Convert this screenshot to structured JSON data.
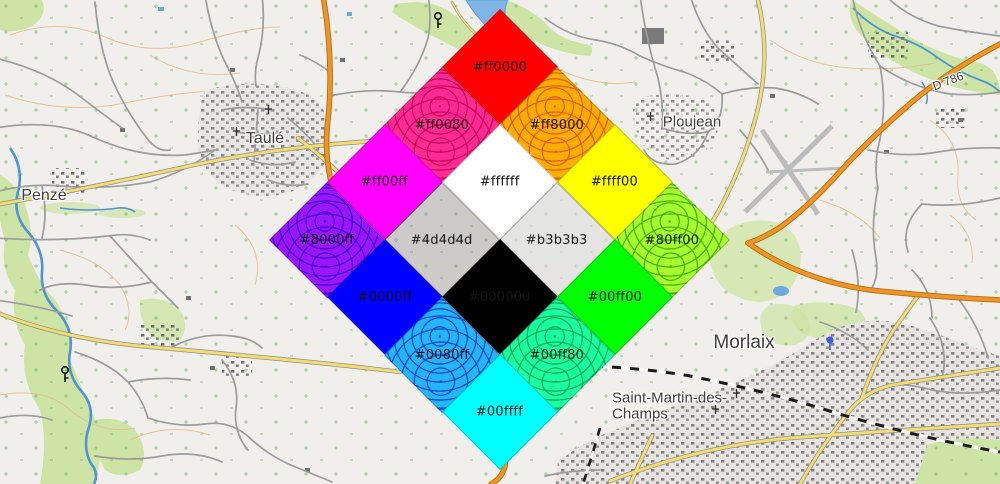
{
  "map": {
    "place_labels": [
      {
        "text": "Taulé",
        "x": 265,
        "y": 139,
        "size": 16
      },
      {
        "text": "Penzé",
        "x": 44,
        "y": 196,
        "size": 16
      },
      {
        "text": "Ploujean",
        "x": 692,
        "y": 122,
        "size": 15
      },
      {
        "text": "Morlaix",
        "x": 744,
        "y": 343,
        "size": 19
      },
      {
        "text": "Saint-Martin-des-",
        "x": 612,
        "y": 398,
        "size": 15,
        "anchor": "start"
      },
      {
        "text": "Champs",
        "x": 612,
        "y": 414,
        "size": 15,
        "anchor": "start"
      },
      {
        "text": "D 786",
        "x": 948,
        "y": 81,
        "size": 12,
        "rotate": -21
      }
    ],
    "palette": {
      "land": "#f1efeb",
      "woodland": "#cde4a4",
      "contour": "#e4bd92",
      "water": "#5d9fd3",
      "road_minor": "#9c9c9c",
      "road_secondary": "#f2dd72",
      "road_primary": "#ef9426",
      "railway": "#1a1a1a",
      "buildings": "#707070",
      "label_color": "#3e3e3e"
    }
  },
  "overlay": {
    "grid": {
      "center_x": 500,
      "top_center_y": 67.5,
      "tile_diagonal": 115
    },
    "tiles": [
      {
        "label": "#ff0000",
        "color": "#ff0000",
        "row": 0,
        "col": 0,
        "kind": "solid"
      },
      {
        "label": "#ff0080",
        "color": "#ff2b92",
        "row": 1,
        "col": 0,
        "kind": "textured",
        "texture_color": "#c7005e"
      },
      {
        "label": "#ff8000",
        "color": "#ffae00",
        "row": 0,
        "col": 1,
        "kind": "textured",
        "texture_color": "#e05d00"
      },
      {
        "label": "#ff00ff",
        "color": "#ff00ff",
        "row": 2,
        "col": 0,
        "kind": "solid"
      },
      {
        "label": "#ffffff",
        "color": "#ffffff",
        "row": 1,
        "col": 1,
        "kind": "solid"
      },
      {
        "label": "#ffff00",
        "color": "#ffff00",
        "row": 0,
        "col": 2,
        "kind": "solid"
      },
      {
        "label": "#8000ff",
        "color": "#9916ff",
        "row": 3,
        "col": 0,
        "kind": "textured",
        "texture_color": "#4b00c2"
      },
      {
        "label": "#4d4d4d",
        "color": "#4d4d4d",
        "row": 2,
        "col": 1,
        "kind": "overlay",
        "overlay_rgba": "rgba(77,77,77,0.22)"
      },
      {
        "label": "#b3b3b3",
        "color": "#b3b3b3",
        "row": 1,
        "col": 2,
        "kind": "overlay",
        "overlay_rgba": "rgba(219,219,219,0.55)"
      },
      {
        "label": "#80ff00",
        "color": "#a6ff2e",
        "row": 0,
        "col": 3,
        "kind": "textured",
        "texture_color": "#47b100"
      },
      {
        "label": "#0000ff",
        "color": "#0000ff",
        "row": 3,
        "col": 1,
        "kind": "solid"
      },
      {
        "label": "#000000",
        "color": "#000000",
        "row": 2,
        "col": 2,
        "kind": "solid"
      },
      {
        "label": "#00ff00",
        "color": "#00ff00",
        "row": 1,
        "col": 3,
        "kind": "solid"
      },
      {
        "label": "#0080ff",
        "color": "#26b4ff",
        "row": 3,
        "col": 2,
        "kind": "textured",
        "texture_color": "#0049c4"
      },
      {
        "label": "#00ff80",
        "color": "#1bffa0",
        "row": 2,
        "col": 3,
        "kind": "textured",
        "texture_color": "#00ae57"
      },
      {
        "label": "#00ffff",
        "color": "#00ffff",
        "row": 3,
        "col": 3,
        "kind": "solid"
      }
    ]
  }
}
